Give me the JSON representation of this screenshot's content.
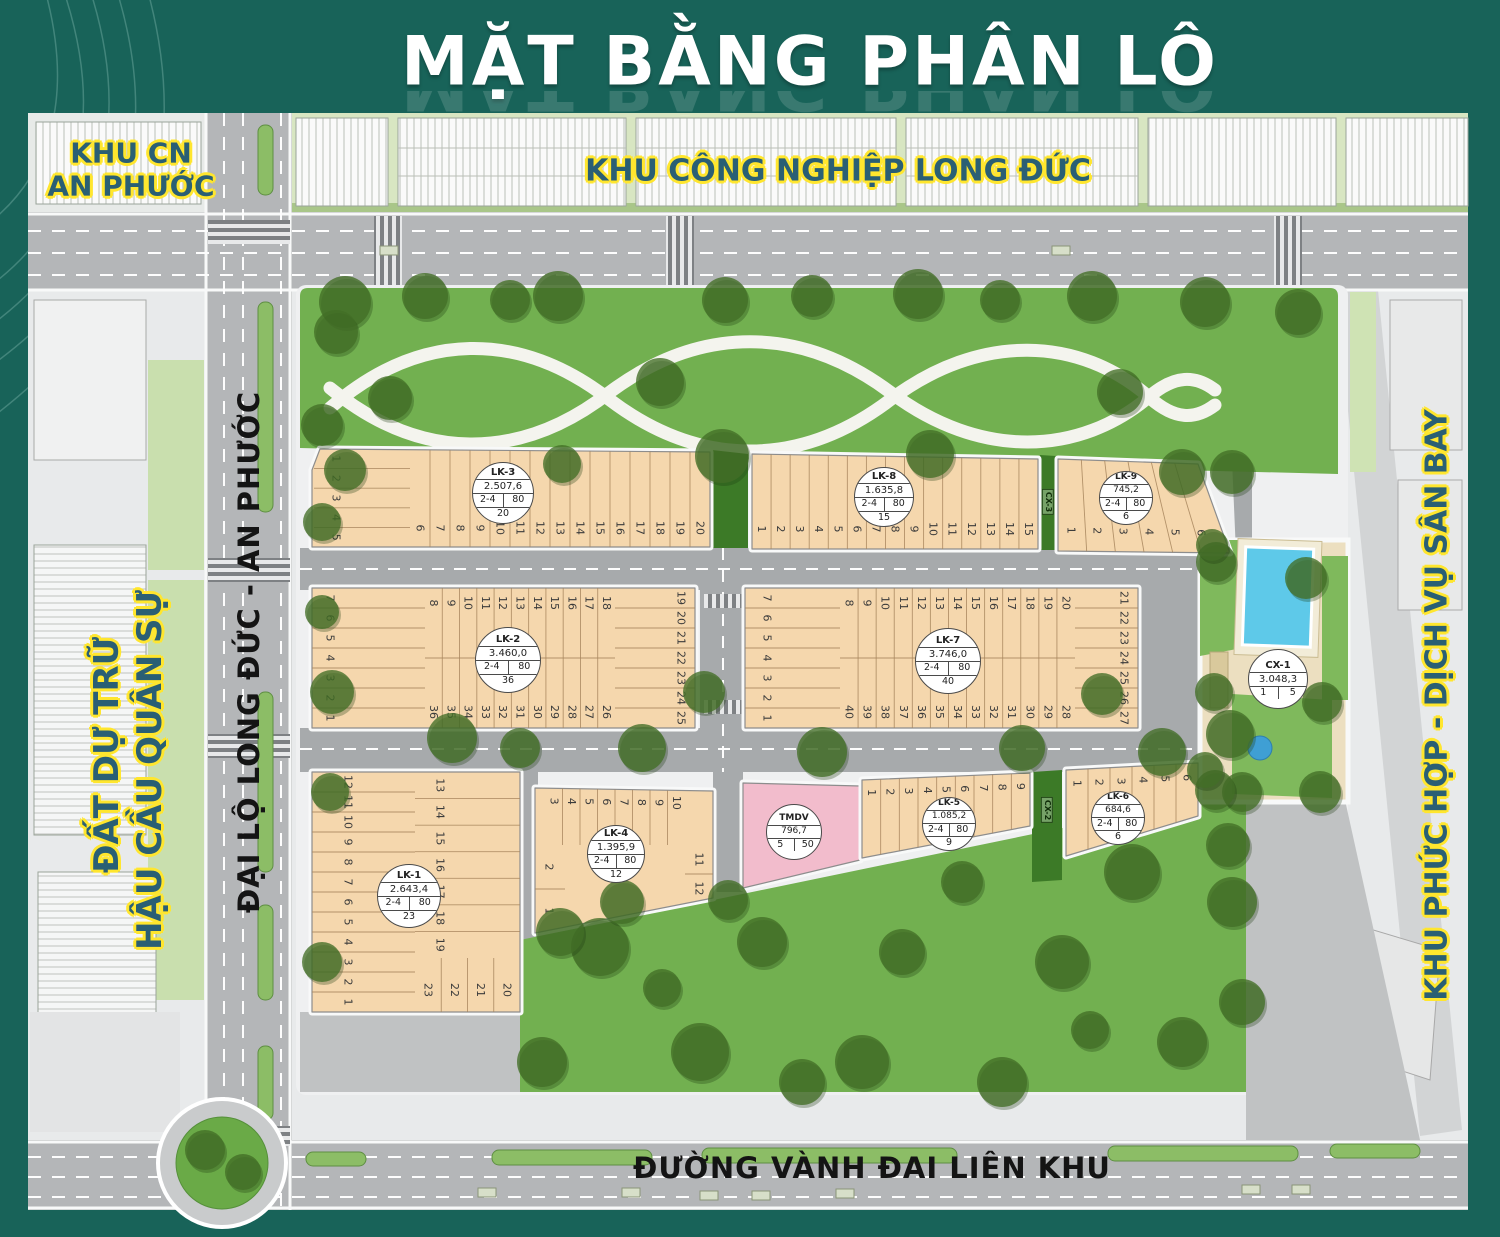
{
  "title": "MẶT BẰNG PHÂN LÔ",
  "labels": {
    "khu_cn_an_phuoc_line1": "KHU CN",
    "khu_cn_an_phuoc_line2": "AN PHƯỚC",
    "khu_cong_nghiep": "KHU CÔNG NGHIỆP LONG ĐỨC",
    "dat_du_tru_line1": "ĐẤT DỰ TRỮ",
    "dat_du_tru_line2": "HẬU CẦU QUÂN SỰ",
    "khu_phuc_hop": "KHU PHỨC HỢP - DỊCH VỤ SÂN BAY",
    "dai_lo": "ĐẠI LỘ LONG ĐỨC - AN PHƯỚC",
    "duong_vanh_dai": "ĐƯỜNG VÀNH ĐAI LIÊN KHU"
  },
  "green_strips": [
    {
      "id": "cx3",
      "name": "CX-3"
    },
    {
      "id": "cx2",
      "name": "CX-2"
    }
  ],
  "blocks": [
    {
      "id": "lk1",
      "name": "LK-1",
      "area": "2.643,4",
      "pair": [
        "2-4",
        "80"
      ],
      "total": "23",
      "lots": {
        "left_rows": [
          12,
          11,
          10,
          9,
          8,
          7,
          6,
          5,
          4,
          3,
          2,
          1
        ],
        "right_rows": [
          13,
          14,
          15,
          16,
          17,
          18,
          19
        ],
        "bottom_strips": [
          23,
          22,
          21,
          20
        ]
      }
    },
    {
      "id": "lk2",
      "name": "LK-2",
      "area": "3.460,0",
      "pair": [
        "2-4",
        "80"
      ],
      "total": "36",
      "lots": {
        "left_rows": [
          7,
          6,
          5,
          4,
          3,
          2,
          1
        ],
        "top_strips": [
          8,
          9,
          10,
          11,
          12,
          13,
          14,
          15,
          16,
          17,
          18
        ],
        "right_rows": [
          19,
          20,
          21,
          22,
          23,
          24,
          25
        ],
        "bottom_strips": [
          36,
          35,
          34,
          33,
          32,
          31,
          30,
          29,
          28,
          27,
          26
        ]
      }
    },
    {
      "id": "lk3",
      "name": "LK-3",
      "area": "2.507,6",
      "pair": [
        "2-4",
        "80"
      ],
      "total": "20",
      "lots": {
        "left_rows": [
          1,
          2,
          3,
          4,
          5
        ],
        "strips": [
          6,
          7,
          8,
          9,
          10,
          11,
          12,
          13,
          14,
          15,
          16,
          17,
          18,
          19,
          20
        ]
      }
    },
    {
      "id": "lk4",
      "name": "LK-4",
      "area": "1.395,9",
      "pair": [
        "2-4",
        "80"
      ],
      "total": "12",
      "lots": {
        "top_strips": [
          3,
          4,
          5,
          6,
          7,
          8,
          9,
          10
        ],
        "left_rows": [
          2,
          1
        ],
        "right_rows": [
          11,
          12
        ]
      }
    },
    {
      "id": "lk5",
      "name": "LK-5",
      "area": "1.085,2",
      "pair": [
        "2-4",
        "80"
      ],
      "total": "9",
      "lots": {
        "strips": [
          1,
          2,
          3,
          4,
          5,
          6,
          7,
          8,
          9
        ]
      }
    },
    {
      "id": "lk6",
      "name": "LK-6",
      "area": "684,6",
      "pair": [
        "2-4",
        "80"
      ],
      "total": "6",
      "lots": {
        "strips": [
          1,
          2,
          3,
          4,
          5,
          6
        ]
      }
    },
    {
      "id": "lk7",
      "name": "LK-7",
      "area": "3.746,0",
      "pair": [
        "2-4",
        "80"
      ],
      "total": "40",
      "lots": {
        "left_rows": [
          7,
          6,
          5,
          4,
          3,
          2,
          1
        ],
        "top_strips": [
          8,
          9,
          10,
          11,
          12,
          13,
          14,
          15,
          16,
          17,
          18,
          19,
          20
        ],
        "right_rows": [
          21,
          22,
          23,
          24,
          25,
          26,
          27
        ],
        "bottom_strips": [
          40,
          39,
          38,
          37,
          36,
          35,
          34,
          33,
          32,
          31,
          30,
          29,
          28
        ]
      }
    },
    {
      "id": "lk8",
      "name": "LK-8",
      "area": "1.635,8",
      "pair": [
        "2-4",
        "80"
      ],
      "total": "15",
      "lots": {
        "strips": [
          1,
          2,
          3,
          4,
          5,
          6,
          7,
          8,
          9,
          10,
          11,
          12,
          13,
          14,
          15
        ]
      }
    },
    {
      "id": "lk9",
      "name": "LK-9",
      "area": "745,2",
      "pair": [
        "2-4",
        "80"
      ],
      "total": "6",
      "lots": {
        "strips": [
          1,
          2,
          3,
          4,
          5,
          6
        ]
      }
    },
    {
      "id": "tmdv",
      "name": "TMDV",
      "area": "796,7",
      "pair": [
        "5",
        "50"
      ]
    },
    {
      "id": "cx1",
      "name": "CX-1",
      "area": "3.048,3",
      "pair": [
        "1",
        "5"
      ]
    }
  ],
  "colors": {
    "frame_teal": "#186359",
    "lot_tan": "#f5d7ad",
    "park_green": "#72b050",
    "hedge_green": "#3c7a27",
    "tmdv_pink": "#f2bccc",
    "pool_blue": "#5ec9e9",
    "highlight_yellow": "#ffe62e",
    "label_teal": "#2a5f74",
    "road_gray": "#b4b6b8"
  }
}
